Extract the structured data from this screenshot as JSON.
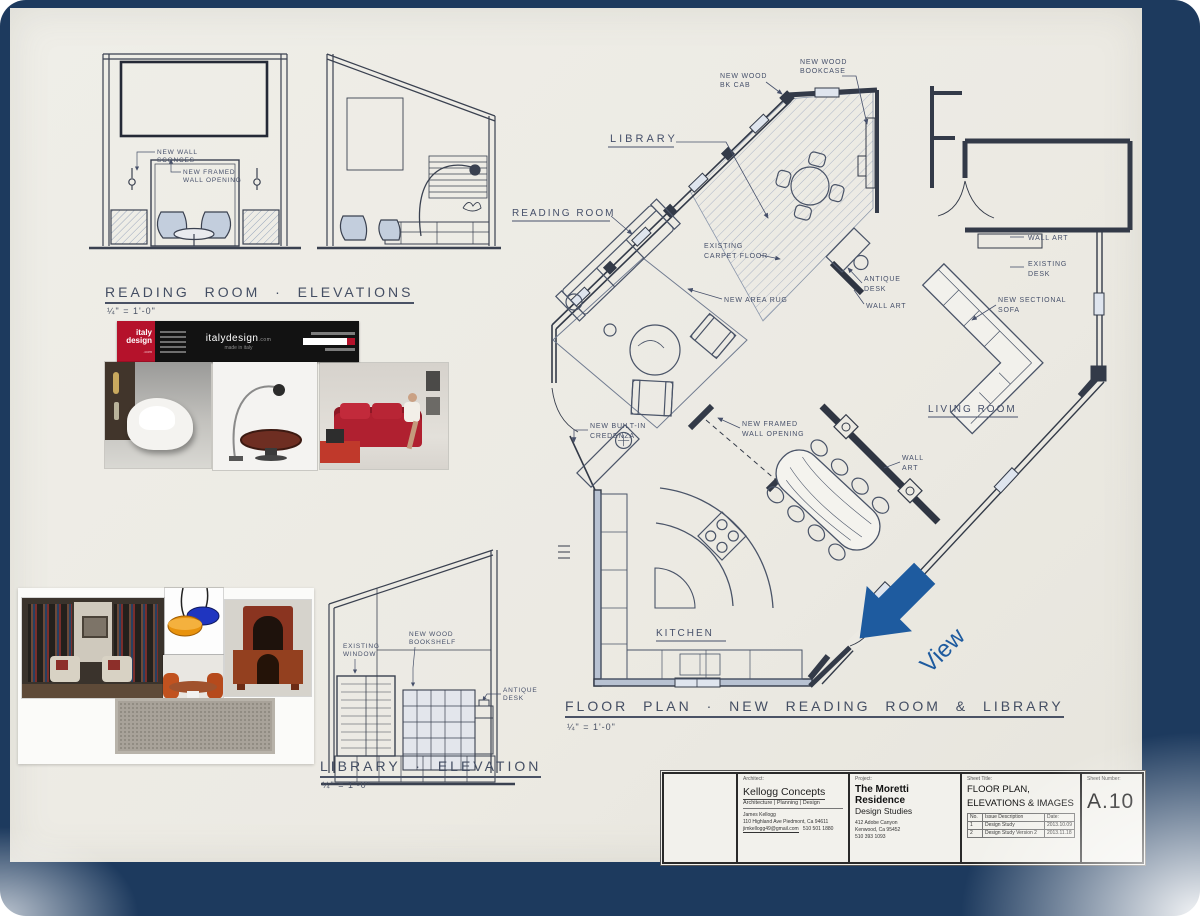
{
  "frame": {
    "navy": "#1d3a5e"
  },
  "headings": {
    "reading_elevations": {
      "title": "READING ROOM · ELEVATIONS",
      "scale": "¼\" = 1'-0\""
    },
    "library_elevation": {
      "title": "LIBRARY · ELEVATION",
      "scale": "¼\" = 1'-0\""
    },
    "floor_plan": {
      "title": "FLOOR PLAN · NEW READING ROOM & LIBRARY",
      "scale": "¼\" = 1'-0\""
    }
  },
  "elevation_labels": {
    "new_wall_sconces_1": "NEW WALL",
    "new_wall_sconces_2": "SCONCES",
    "new_framed_opening_1": "NEW FRAMED",
    "new_framed_opening_2": "WALL OPENING",
    "existing_window_1": "EXISTING",
    "existing_window_2": "WINDOW",
    "new_wood_bookshelf_1": "NEW WOOD",
    "new_wood_bookshelf_2": "BOOKSHELF",
    "antique_desk_1": "ANTIQUE",
    "antique_desk_2": "DESK"
  },
  "plan_labels": {
    "library": "LIBRARY",
    "reading_room": "READING ROOM",
    "living_room": "LIVING ROOM",
    "kitchen": "KITCHEN",
    "new_wood_bkcab_1": "NEW WOOD",
    "new_wood_bkcab_2": "BK CAB",
    "new_wood_bookcase_1": "NEW WOOD",
    "new_wood_bookcase_2": "BOOKCASE",
    "existing_carpet_1": "EXISTING",
    "existing_carpet_2": "CARPET FLOOR",
    "new_area_rug": "NEW AREA RUG",
    "antique_desk_1": "ANTIQUE",
    "antique_desk_2": "DESK",
    "wall_art_library": "WALL ART",
    "wall_art_right": "WALL ART",
    "existing_desk_1": "EXISTING",
    "existing_desk_2": "DESK",
    "new_sectional_1": "NEW SECTIONAL",
    "new_sectional_2": "SOFA",
    "wall_art_dining_1": "WALL",
    "wall_art_dining_2": "ART",
    "new_framed_1": "NEW FRAMED",
    "new_framed_2": "WALL OPENING",
    "new_builtin_1": "NEW BUILT-IN",
    "new_builtin_2": "CREDENZA",
    "view": "View"
  },
  "banner": {
    "logo_top": "italy",
    "logo_bottom": "design",
    "logo_com": ".com",
    "site_name": "italydesign",
    "site_com": ".com",
    "tagline": "made in italy"
  },
  "title_block": {
    "architect": {
      "label": "Architect:",
      "firm": "Kellogg Concepts",
      "tagline": "Architecture | Planning | Design",
      "person": "James Kellogg",
      "address": "110 Highland Ave    Piedmont, Ca    94611",
      "email": "jimkellogg49@gmail.com",
      "phone": "510 501 1880"
    },
    "project": {
      "label": "Project:",
      "name": "The Moretti Residence",
      "subtitle": "Design Studies",
      "address1": "412 Adobe Canyon",
      "address2": "Kenwood, Ca  95452",
      "phone": "510 393 1093"
    },
    "sheet": {
      "label": "Sheet Title:",
      "title_line1": "FLOOR PLAN,",
      "title_line2": "ELEVATIONS & IMAGES",
      "issues_headers": [
        "No.",
        "Issue Description",
        "Date:"
      ],
      "issues_rows": [
        [
          "1",
          "Design Study",
          "2013.10.09"
        ],
        [
          "2",
          "Design Study Version 2",
          "2013.11.18"
        ]
      ]
    },
    "number": {
      "label": "Sheet Number:",
      "value": "A.10"
    }
  }
}
